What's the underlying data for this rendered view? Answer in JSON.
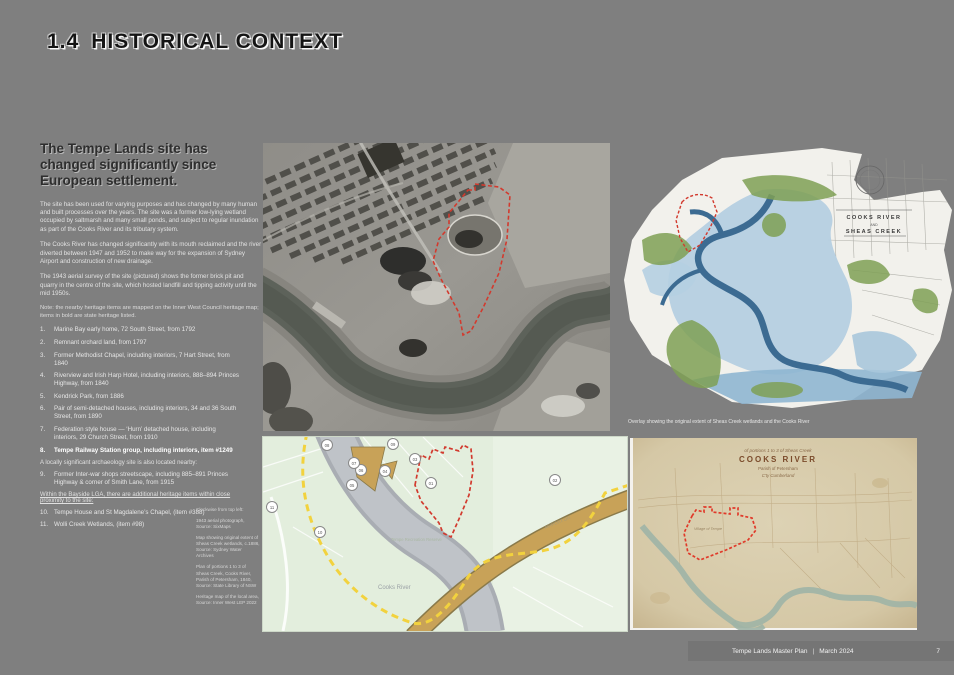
{
  "page": {
    "section_number": "1.4",
    "section_title": "HISTORICAL CONTEXT",
    "background_color": "#7f7f7f",
    "accent_red": "#d23a2e"
  },
  "intro": {
    "heading": "The Tempe Lands site has changed significantly since European settlement.",
    "paragraphs": [
      "The site has been used for varying purposes and has changed by many human and built processes over the years. The site was a former low-lying wetland occupied by saltmarsh and many small ponds, and subject to regular inundation as part of the Cooks River and its tributary system.",
      "The Cooks River has changed significantly with its mouth reclaimed and the river diverted between 1947 and 1952 to make way for the expansion of Sydney Airport and construction of new drainage.",
      "The 1943 aerial survey of the site (pictured) shows the former brick pit and quarry in the centre of the site, which hosted landfill and tipping activity until the mid 1950s."
    ],
    "note": "Note: the nearby heritage items are mapped on the Inner West Council heritage map; items in bold are state heritage listed."
  },
  "heritage_list": {
    "items": [
      {
        "num": "1.",
        "text": "Marine Bay early home, 72 South Street, from 1792"
      },
      {
        "num": "2.",
        "text": "Remnant orchard land, from 1797"
      },
      {
        "num": "3.",
        "text": "Former Methodist Chapel, including interiors, 7 Hart Street, from 1840"
      },
      {
        "num": "4.",
        "text": "Riverview and Irish Harp Hotel, including interiors, 888–894 Princes Highway, from 1840"
      },
      {
        "num": "5.",
        "text": "Kendrick Park, from 1886"
      },
      {
        "num": "6.",
        "text": "Pair of semi-detached houses, including interiors, 34 and 36 South Street, from 1890"
      },
      {
        "num": "7.",
        "text": "Federation style house — ‘Hurn’ detached house, including interiors, 29 Church Street, from 1910"
      },
      {
        "num": "8.",
        "text": "Tempe Railway Station group, including interiors, item #1249"
      },
      {
        "num": "9.",
        "text": "Former Inter-war shops streetscape, including 885–891 Princes Highway & corner of Smith Lane, from 1915"
      }
    ],
    "archaeology_note": "A locally significant archaeology site is also located nearby:",
    "bayside_note": "Within the Bayside LGA, there are additional heritage items within close proximity to the site:",
    "additional_items": [
      {
        "num": "10.",
        "text": "Tempe House and St Magdalene’s Chapel, (item #388)"
      },
      {
        "num": "11.",
        "text": "Wolli Creek Wetlands, (item #98)"
      }
    ]
  },
  "captions": {
    "clockwise": "Clockwise from top left:",
    "items": [
      "1943 aerial photograph, Source: SixMaps",
      "Map showing original extent of Sheas Creek wetlands, c.1886, Source: Sydney Water Archives",
      "Plan of portions 1 to 3 of Sheas Creek, Cooks River, Parish of Petersham, 1840, Source: State Library of NSW",
      "Heritage map of the local area, Source: Inner West LEP 2022"
    ]
  },
  "maps": {
    "historic": {
      "title_line1": "COOKS RIVER",
      "title_line2": "AND",
      "title_line3": "SHEAS CREEK",
      "caption": "Overlay showing the original extent of Sheas Creek wetlands and the Cooks River"
    },
    "modern": {
      "river_label": "Cooks River",
      "road_label": "AIRPORT DR",
      "reserve_label": "Tempe Recreation Reserve",
      "markers": [
        "01",
        "02",
        "03",
        "04",
        "05",
        "06",
        "07",
        "08",
        "09",
        "10",
        "11"
      ]
    },
    "parchment": {
      "subtitle": "of portions 1 to 3 of Sheas Creek",
      "title": "COOKS RIVER",
      "line3": "Parish of Petersham",
      "line4": "C'ty Cumberland",
      "village_label": "Village of Tempe"
    }
  },
  "footer": {
    "doc_title": "Tempe Lands Master Plan",
    "separator": "|",
    "date": "March 2024",
    "page_number": "7"
  }
}
